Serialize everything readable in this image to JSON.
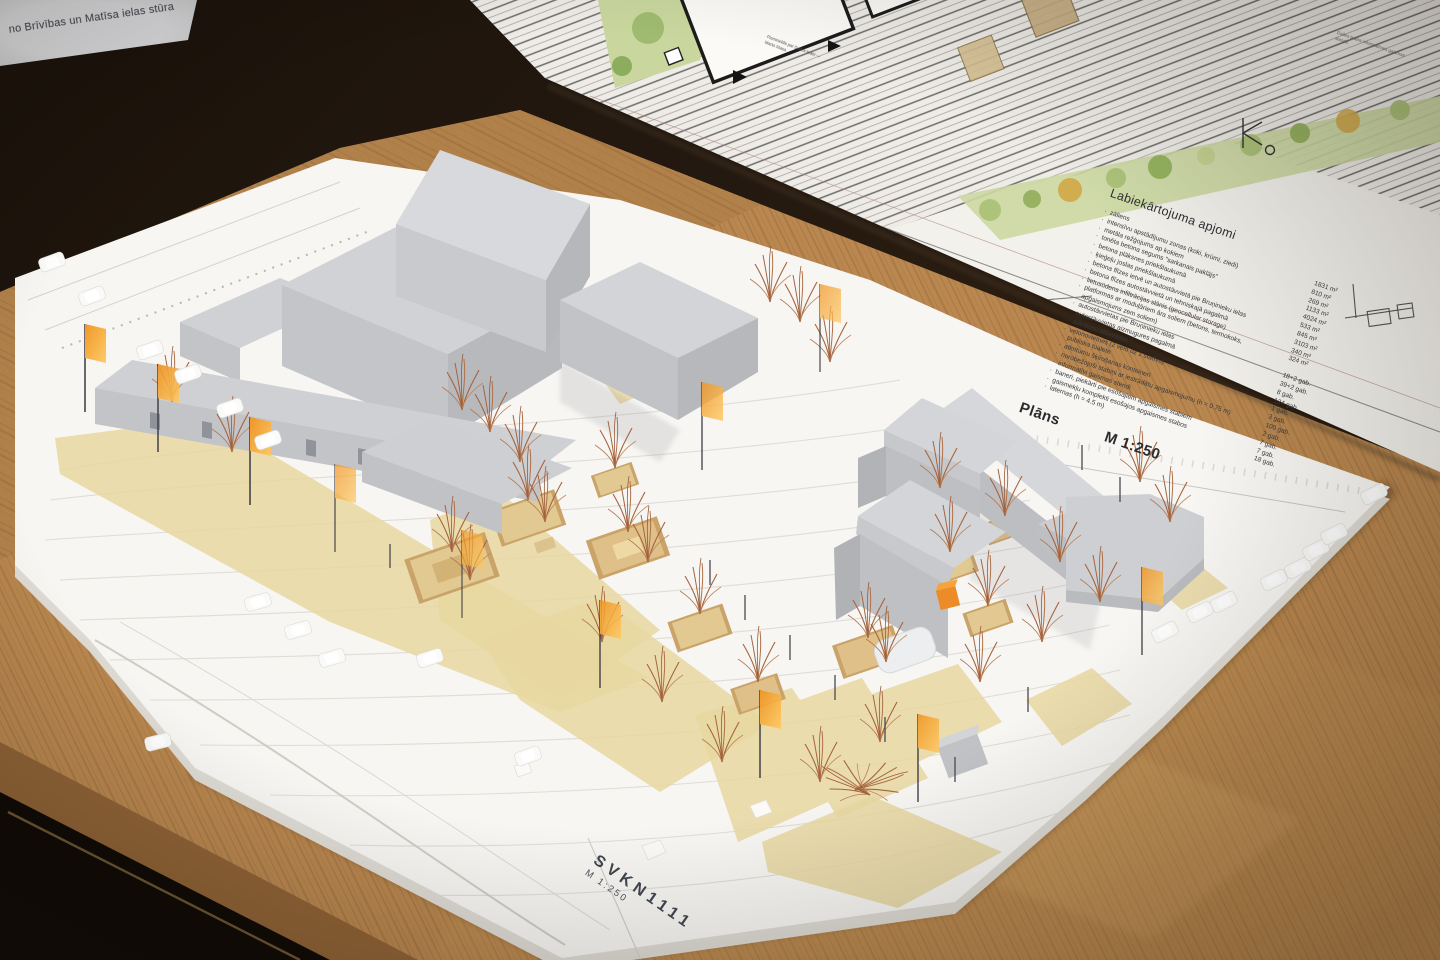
{
  "scene": {
    "description": "Photograph of a white architectural scale model (Dailes Theatre square, 1:250) standing on an oak table in front of a tilted site-plan presentation board",
    "colors": {
      "background_dark": "#1c130b",
      "table_wood": "#b9874f",
      "table_wood_dark": "#8a6238",
      "board_white": "#f3f1ec",
      "base_white": "#f7f6f3",
      "building_gray": "#c7c9cc",
      "building_gray_dark": "#b4b6ba",
      "carpet_tan": "#e7d7a0",
      "platform_wood": "#dfc790",
      "platform_frame": "#c9a368",
      "tree_copper": "#a5643f",
      "flag_orange": "#f5a42c",
      "plan_green": "#ccd8a2",
      "plan_line": "#6b6b68"
    }
  },
  "paper_note": {
    "text": "no Brīvības un Matīsa ielas stūra"
  },
  "plan_board": {
    "title": "Labiekārtojuma apjomi",
    "items": [
      {
        "label": "zāliens",
        "value": "1831 m²"
      },
      {
        "label": "intensīvu apstādījumu zonas (koki, krūmi, ziedi)",
        "value": "810 m²"
      },
      {
        "label": "metāla režģojums ap kokiem",
        "value": "269 m²"
      },
      {
        "label": "tonēta betona segums \"sarkanais paklājs\"",
        "value": "1133 m²"
      },
      {
        "label": "betona plāksnes priekšlaukumā",
        "value": "4024 m²"
      },
      {
        "label": "ķieģeļu joslas priekšlaukumā",
        "value": "533 m²"
      },
      {
        "label": "betona flīzes ietvē un autostāvvietā pie Bruņinieku ielas",
        "value": "845 m²"
      },
      {
        "label": "betona flīzes autostāvvietā un tehniskajā pagalmā",
        "value": "3103 m²"
      },
      {
        "label": "lietusūdens infiltrācijas slānis (geocellular storage)",
        "value": "340 m²"
      },
      {
        "label": "platformas ar moduļāriem āra soliem (betons, termokoks, apgaismojums zem soliem)",
        "value": "324 m²"
      },
      {
        "label": "autostāvvietas pie Bruņinieku ielas",
        "value": "18+2 gab."
      },
      {
        "label": "autostāvvietas aizmugures pagalmā",
        "value": "39+2 gab."
      },
      {
        "label": "autobusu stāvvietas",
        "value": "8 gab."
      },
      {
        "label": "velonovietnes (2 velo uz 1 statīvu)",
        "value": "124 gab."
      },
      {
        "label": "publiska tualete",
        "value": "1 gab."
      },
      {
        "label": "atkritumu šķirošanas konteineri",
        "value": "3 gab."
      },
      {
        "label": "norobežojoši stabiņi ar iestrādātu apgaismojumu (h = 0.75 m)",
        "value": "100 gab."
      },
      {
        "label": "informatīvi gaismas stendi",
        "value": "2 gab."
      },
      {
        "label": "baneri, piekārti pie esošajiem apgaismes stabiem",
        "value": "7 gab."
      },
      {
        "label": "gaismekļu komplekti esošajos apgaismes stabos",
        "value": "7 gab."
      },
      {
        "label": "laternas (h = 4.5 m)",
        "value": "18 gab."
      }
    ],
    "plan_label": "Plāns",
    "scale": "M 1:250",
    "annotations": {
      "stand_note": "Dailes teātra informatīvais gaismas stends",
      "monument_note": "Piemineklis par Dailes teātri — Marta Staņa"
    }
  },
  "model": {
    "code": "SVKN1111",
    "scale": "M 1:250"
  }
}
